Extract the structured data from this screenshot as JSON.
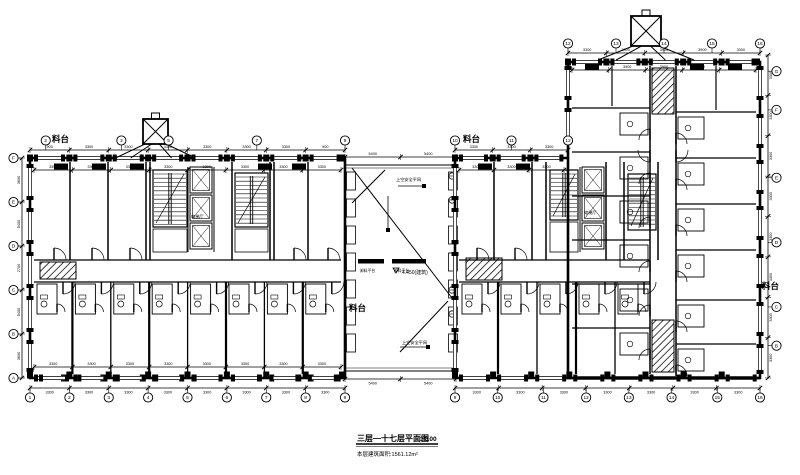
{
  "title_block": {
    "title": "三层—十七层平面图",
    "scale": "1:100",
    "area_note": "本层建筑面积:1561.12m²"
  },
  "labels": {
    "platform": "料台",
    "level": "4.450(建筑)"
  },
  "annotations": {
    "top_net": "上空安全平网",
    "bottom_net": "上空安全平网",
    "unload": "卸料平台",
    "elevator": "电梯厅"
  },
  "colors": {
    "ink": "#000000",
    "paper": "#ffffff"
  },
  "dimensions": {
    "left_top": [
      "900",
      "3300",
      "3300",
      "3300",
      "3300",
      "3300",
      "3300",
      "900"
    ],
    "left_inner_top": [
      "3300",
      "3300",
      "3300",
      "3300",
      "3300",
      "3300",
      "3300",
      "3300"
    ],
    "left_bottom": [
      "3300",
      "3300",
      "3300",
      "3300",
      "3300",
      "3300",
      "3300",
      "3300"
    ],
    "left_side": [
      "3600",
      "5400",
      "2700",
      "5400",
      "3600"
    ],
    "right_top": [
      "3300",
      "3300",
      "3300"
    ],
    "right_inner_top": [
      "3300",
      "3300",
      "3300"
    ],
    "block_top": [
      "3300",
      "3900",
      "3900",
      "3900",
      "3300"
    ],
    "block_inner_top": [
      "3300",
      "3900",
      "3900",
      "3900",
      "3300"
    ],
    "block_right": [
      "3300",
      "3300",
      "3300",
      "3300",
      "3300",
      "3300",
      "3300",
      "3300"
    ],
    "right_bottom": [
      "3300",
      "3300",
      "3300",
      "3300",
      "3300",
      "3300",
      "3300"
    ],
    "connector_top": [
      "5400",
      "5400"
    ],
    "connector_bottom": [
      "5400",
      "5400"
    ]
  },
  "grid": {
    "left_top": [
      "2",
      "3",
      "5",
      "7",
      "9"
    ],
    "left_bottom": [
      "1",
      "2",
      "3",
      "4",
      "5",
      "6",
      "7",
      "8",
      "9"
    ],
    "left_side": [
      "F",
      "E",
      "D",
      "C",
      "B",
      "A"
    ],
    "right_top": [
      "10",
      "11",
      "12"
    ],
    "block_top": [
      "12",
      "13",
      "14",
      "15",
      "16"
    ],
    "block_right": [
      "G",
      "F",
      "E",
      "D",
      "C",
      "B"
    ],
    "right_bottom": [
      "9",
      "10",
      "11",
      "12",
      "13",
      "14",
      "15",
      "16"
    ]
  }
}
